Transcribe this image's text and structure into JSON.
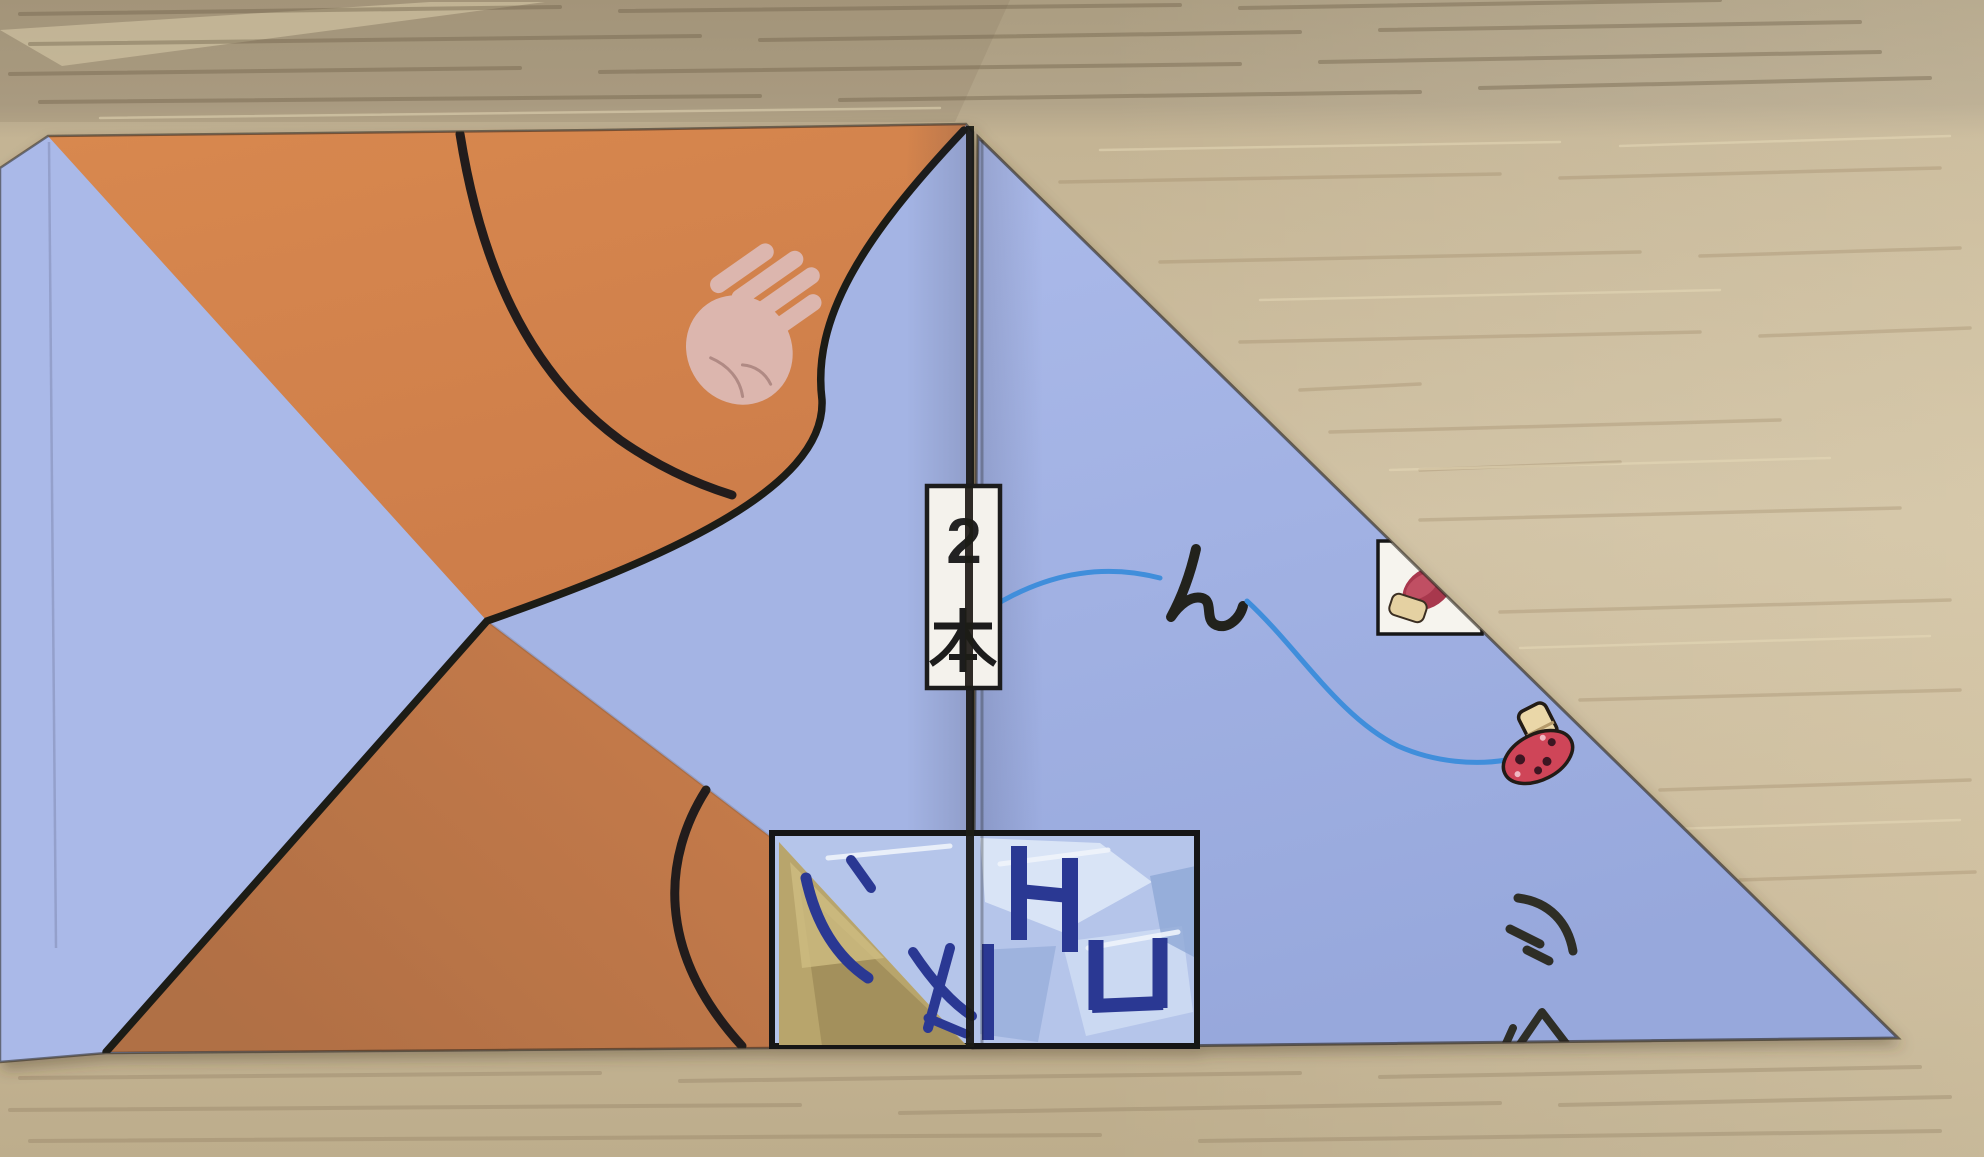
{
  "scene": {
    "type": "photograph",
    "subject": "folded origami paper on wooden desk",
    "description": "A partially folded printed origami sheet (blue and orange triangles) lying on a light wood grain desk"
  },
  "glyphs": {
    "count_number": "2",
    "count_unit_kanji": "本",
    "hiragana_n": "ん",
    "katakana_shi": "シ",
    "partial_glyph": "ク",
    "ice_letters": [
      "H",
      "U"
    ]
  },
  "icons": {
    "hand": "hand-illustration",
    "mushroom_sticker": "mushroom-icon",
    "mushroom_partial": "mushroom-partial-icon",
    "ice_panel": "ice-cubes-picture",
    "dune": "sand-dune-picture",
    "arcs": "printed-ball-arcs",
    "thread": "blue-thread-curve"
  },
  "colors": {
    "paper_blue": "#a6b5e6",
    "paper_blue_dark": "#98a9dd",
    "paper_orange": "#d2834e",
    "paper_orange_dark": "#b3754a",
    "pattern_line": "#1d1c19",
    "thread_blue": "#3f8edb",
    "navy_letters": "#2c3893",
    "mushroom_red": "#cf4458",
    "label_box_bg": "#f4f2ec",
    "hand_pink": "#dcb6ae",
    "dune_tan": "#b8a56c",
    "ice_blue": "#b5c5ea",
    "wood_light": "#cbbb9c",
    "wood_dark": "#a3957a"
  }
}
